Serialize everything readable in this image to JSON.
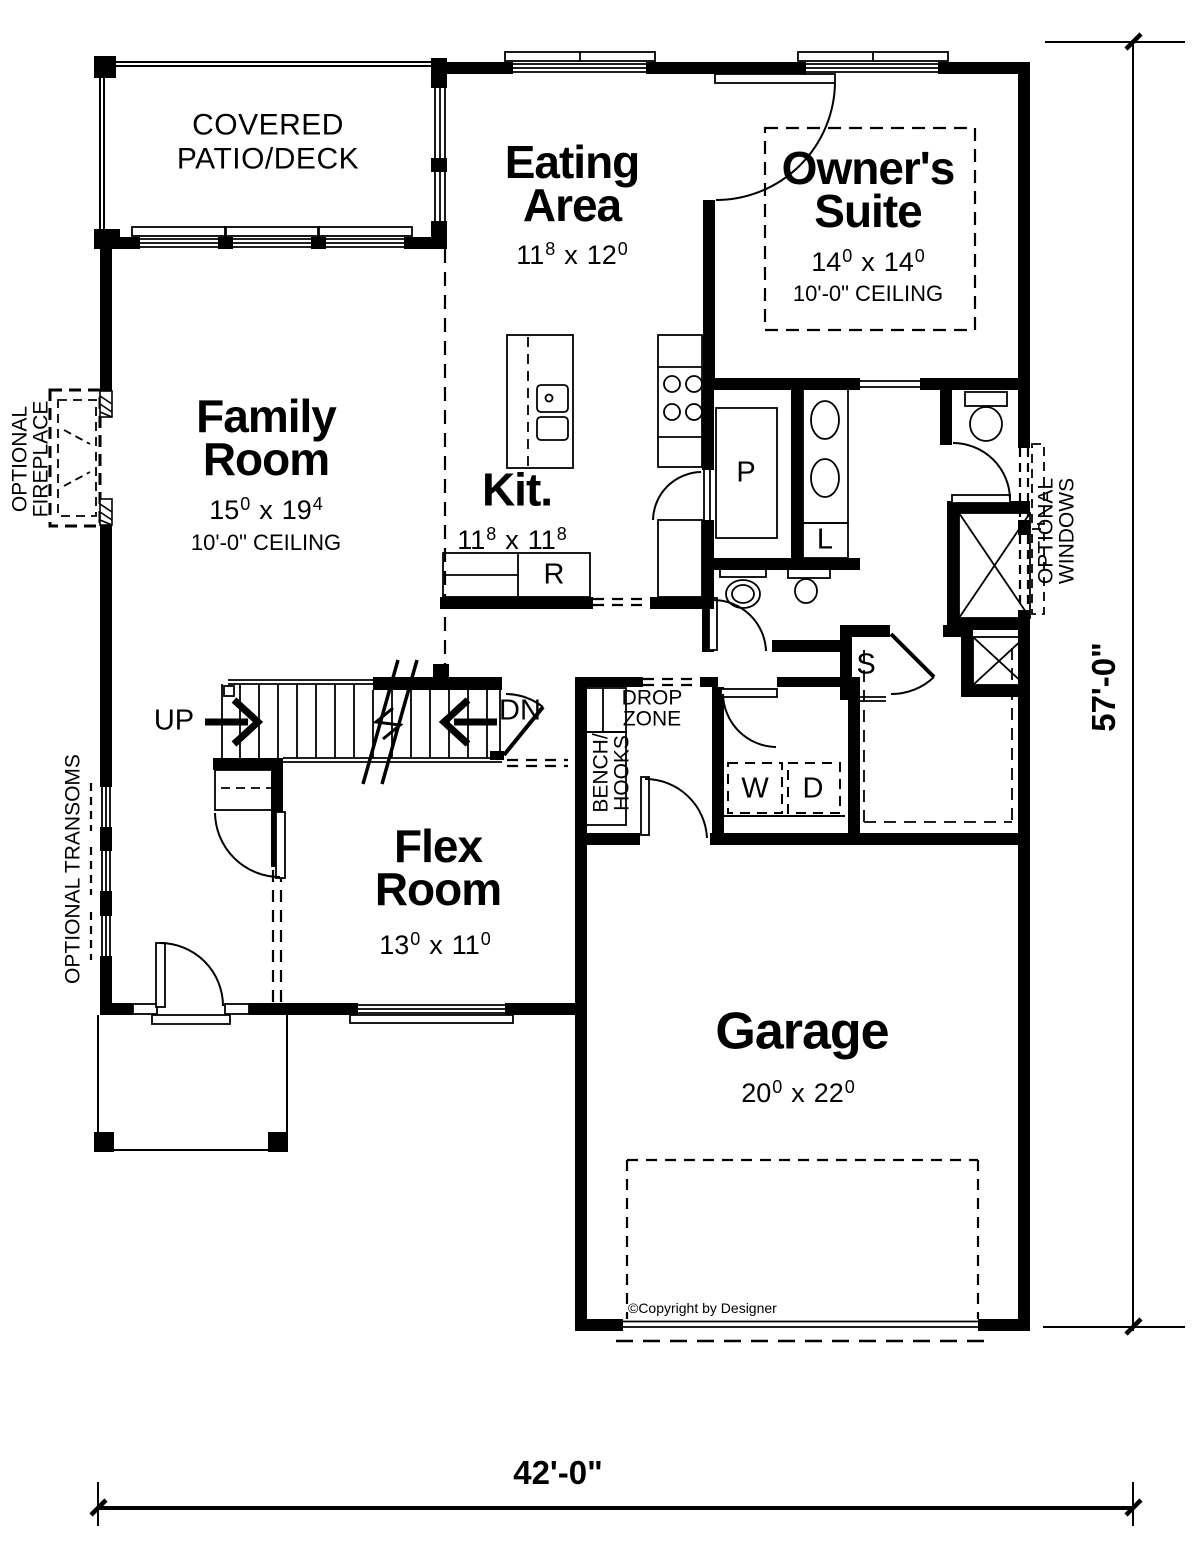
{
  "rooms": {
    "patio": {
      "name": "COVERED\nPATIO/DECK"
    },
    "eating": {
      "name": "Eating\nArea",
      "dim_a": "11",
      "dim_a_sup": "8",
      "dim_sep": "x",
      "dim_b": "12",
      "dim_b_sup": "0"
    },
    "owner": {
      "name": "Owner's\nSuite",
      "dim_a": "14",
      "dim_a_sup": "0",
      "dim_sep": "x",
      "dim_b": "14",
      "dim_b_sup": "0",
      "ceiling": "10'-0\" CEILING"
    },
    "family": {
      "name": "Family\nRoom",
      "dim_a": "15",
      "dim_a_sup": "0",
      "dim_sep": "x",
      "dim_b": "19",
      "dim_b_sup": "4",
      "ceiling": "10'-0\" CEILING"
    },
    "kitchen": {
      "name": "Kit.",
      "dim_a": "11",
      "dim_a_sup": "8",
      "dim_sep": "x",
      "dim_b": "11",
      "dim_b_sup": "8"
    },
    "flex": {
      "name": "Flex\nRoom",
      "dim_a": "13",
      "dim_a_sup": "0",
      "dim_sep": "x",
      "dim_b": "11",
      "dim_b_sup": "0"
    },
    "garage": {
      "name": "Garage",
      "dim_a": "20",
      "dim_a_sup": "0",
      "dim_sep": "x",
      "dim_b": "22",
      "dim_b_sup": "0"
    }
  },
  "annotations": {
    "up": "UP",
    "dn": "DN",
    "drop_zone": "DROP\nZONE",
    "bench_hooks": "BENCH/\nHOOKS",
    "washer": "W",
    "dryer": "D",
    "pantry": "P",
    "linen": "L",
    "shelf": "S",
    "range": "R",
    "optional_fireplace": "OPTIONAL\nFIREPLACE",
    "optional_transoms": "OPTIONAL TRANSOMS",
    "optional_windows": "OPTIONAL WINDOWS",
    "copyright": "©Copyright by Designer"
  },
  "dimensions": {
    "overall_width": "42'-0\"",
    "overall_depth": "57'-0\""
  },
  "colors": {
    "ink": "#000000",
    "paper": "#ffffff"
  }
}
